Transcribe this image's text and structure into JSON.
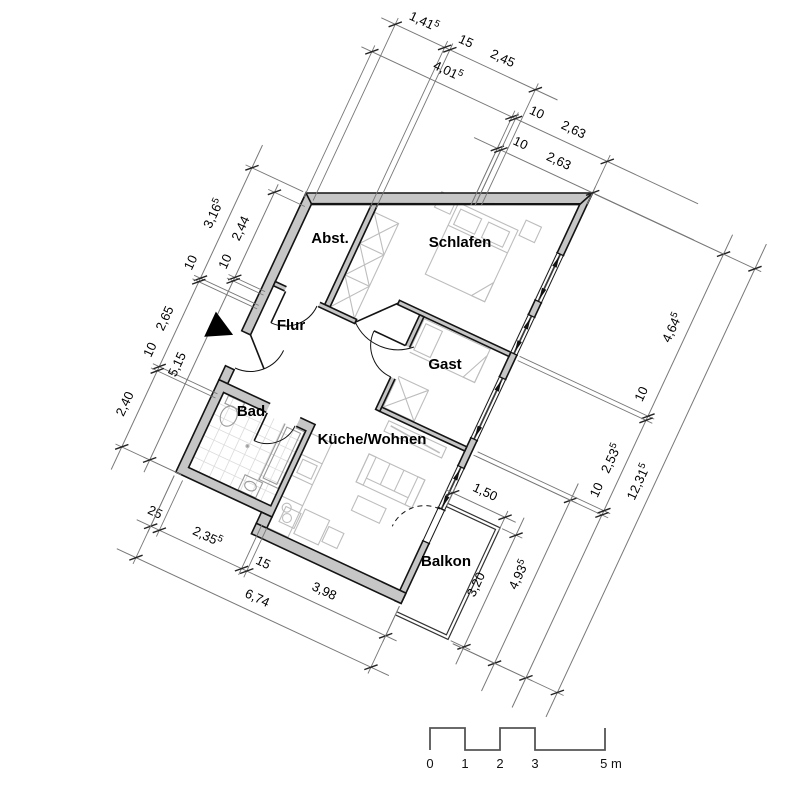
{
  "drawing_type": "apartment floor plan",
  "colors": {
    "wall_fill": "#c6c6c6",
    "outline": "#141414",
    "dim_line": "#787878",
    "dim_text": "#000000",
    "furniture": "#bdbdbd",
    "tile": "#dcdcdc",
    "fixture": "#9a9a9a",
    "glass": "#3c3c3c",
    "background": "#ffffff"
  },
  "rooms": [
    {
      "label": "Abst.",
      "x": 330,
      "y": 243
    },
    {
      "label": "Schlafen",
      "x": 460,
      "y": 247
    },
    {
      "label": "Flur",
      "x": 291,
      "y": 330
    },
    {
      "label": "Gast",
      "x": 445,
      "y": 369
    },
    {
      "label": "Bad",
      "x": 251,
      "y": 416
    },
    {
      "label": "Küche/Wohnen",
      "x": 372,
      "y": 444
    },
    {
      "label": "Balkon",
      "x": 446,
      "y": 566
    }
  ],
  "dimensions": [
    {
      "id": "top-1",
      "axis": "u",
      "line": -4.95,
      "start": -0.15,
      "end": 4.9,
      "ticks": [
        [
          0.25,
          0.1
        ],
        [
          1.665,
          -0.35
        ],
        [
          1.815,
          -0.42
        ],
        [
          4.265,
          -1.63
        ]
      ],
      "labels": [
        {
          "at": 0.9,
          "text": "1,41",
          "sup": "5"
        },
        {
          "at": 2.1,
          "text": "15"
        },
        {
          "at": 3.15,
          "text": "2,45"
        }
      ]
    },
    {
      "id": "top-2",
      "axis": "u",
      "line": -4.05,
      "start": -0.3,
      "end": 9.35,
      "ticks": [
        [
          0,
          0.12
        ],
        [
          4.015,
          -1.52
        ],
        [
          4.115,
          -1.56
        ],
        [
          6.745,
          -2.82
        ]
      ],
      "labels": [
        {
          "at": 2.0,
          "text": "4,01",
          "sup": "5"
        },
        {
          "at": 4.55,
          "text": "10"
        },
        {
          "at": 5.6,
          "text": "2,63"
        }
      ]
    },
    {
      "id": "top-3",
      "axis": "u",
      "line": -3.15,
      "start": 3.35,
      "end": 9.65,
      "ticks": [
        [
          4.015,
          -1.52
        ],
        [
          4.115,
          -1.56
        ],
        [
          6.745,
          -2.82
        ]
      ],
      "labels": [
        {
          "at": 4.5,
          "text": "10"
        },
        {
          "at": 5.6,
          "text": "2,63"
        }
      ]
    },
    {
      "id": "bottom-1",
      "axis": "u",
      "line": 9.55,
      "start": -0.4,
      "end": 7.05,
      "ticks": [
        [
          0,
          8.1
        ],
        [
          0.25,
          8.12
        ],
        [
          2.605,
          8.3
        ],
        [
          2.755,
          8.32
        ],
        [
          6.735,
          8.7
        ]
      ],
      "labels": [
        {
          "at": -0.05,
          "text": "25"
        },
        {
          "at": 1.45,
          "text": "2,35",
          "sup": "5"
        },
        {
          "at": 3.05,
          "text": "15"
        },
        {
          "at": 4.8,
          "text": "3,98"
        }
      ]
    },
    {
      "id": "bottom-2",
      "axis": "u",
      "line": 10.45,
      "start": -0.55,
      "end": 7.25,
      "ticks": [
        [
          0,
          8.1
        ],
        [
          6.735,
          8.7
        ]
      ],
      "labels": [
        {
          "at": 3.3,
          "text": "6,74"
        }
      ]
    },
    {
      "id": "balcony-width",
      "axis": "u",
      "line": 5.45,
      "start": 6.55,
      "end": 8.55,
      "ticks": [
        [
          6.745,
          5.82
        ],
        [
          8.245,
          5.85
        ]
      ],
      "labels": [
        {
          "at": 7.5,
          "text": "1,50"
        }
      ]
    },
    {
      "id": "left-outer",
      "axis": "v",
      "line": -1.55,
      "start": -0.65,
      "end": 8.65,
      "ticks": [
        [
          0,
          -0.08
        ],
        [
          3.165,
          0.12
        ],
        [
          3.265,
          0.12
        ],
        [
          5.7,
          0.12
        ],
        [
          5.82,
          0.12
        ],
        [
          8.0,
          0.15
        ]
      ],
      "labels": [
        {
          "at": 1.5,
          "text": "3,16",
          "sup": "5"
        },
        {
          "at": 2.9,
          "text": "10"
        },
        {
          "at": 4.5,
          "text": "2,65"
        },
        {
          "at": 5.4,
          "text": "10"
        },
        {
          "at": 6.95,
          "text": "2,40"
        }
      ]
    },
    {
      "id": "left-inner",
      "axis": "v",
      "line": -0.75,
      "start": 0.1,
      "end": 8.35,
      "ticks": [
        [
          0.33,
          0.12
        ],
        [
          2.77,
          0.12
        ],
        [
          2.87,
          0.12
        ],
        [
          8.0,
          0.15
        ]
      ],
      "labels": [
        {
          "at": 1.55,
          "text": "2,44"
        },
        {
          "at": 2.5,
          "text": "10"
        },
        {
          "at": 5.45,
          "text": "5,15"
        }
      ]
    },
    {
      "id": "balcony-depth",
      "axis": "v",
      "line": 8.7,
      "start": 5.25,
      "end": 9.45,
      "ticks": [
        [
          5.75,
          8.3
        ],
        [
          8.95,
          8.32
        ]
      ],
      "labels": [
        {
          "at": 7.35,
          "text": "3,20"
        }
      ]
    },
    {
      "id": "right-1",
      "axis": "v",
      "line": 9.6,
      "start": 3.85,
      "end": 9.8,
      "ticks": [
        [
          4.33,
          6.82
        ],
        [
          9.0,
          8.4
        ]
      ],
      "labels": [
        {
          "at": 6.65,
          "text": "4,93",
          "sup": "5"
        }
      ]
    },
    {
      "id": "right-2",
      "axis": "v",
      "line": 10.5,
      "start": -3.7,
      "end": 9.85,
      "ticks": [
        [
          -3.145,
          6.82
        ],
        [
          1.5,
          6.82
        ],
        [
          1.62,
          6.82
        ],
        [
          4.21,
          6.88
        ],
        [
          4.33,
          6.88
        ],
        [
          9.0,
          8.42
        ]
      ],
      "labels": [
        {
          "at": -0.85,
          "text": "4,64",
          "sup": "5"
        },
        {
          "at": 1.05,
          "text": "10"
        },
        {
          "at": 2.9,
          "text": "2,53",
          "sup": "5"
        },
        {
          "at": 3.8,
          "text": "10"
        }
      ]
    },
    {
      "id": "right-outer",
      "axis": "v",
      "line": 11.4,
      "start": -3.85,
      "end": 9.7,
      "ticks": [
        [
          -3.145,
          6.82
        ],
        [
          9.0,
          8.42
        ]
      ],
      "labels": [
        {
          "at": 3.15,
          "text": "12,31",
          "sup": "5"
        }
      ]
    }
  ],
  "scale_bar": {
    "x0": 430,
    "y_base": 750,
    "y_top": 728,
    "px_per_m": 35,
    "marks": [
      {
        "m": 0,
        "label": "0"
      },
      {
        "m": 1,
        "label": "1"
      },
      {
        "m": 2,
        "label": "2"
      },
      {
        "m": 3,
        "label": "3"
      },
      {
        "m": 5,
        "label": "5 m"
      }
    ]
  },
  "entrance_marker": "arrow"
}
